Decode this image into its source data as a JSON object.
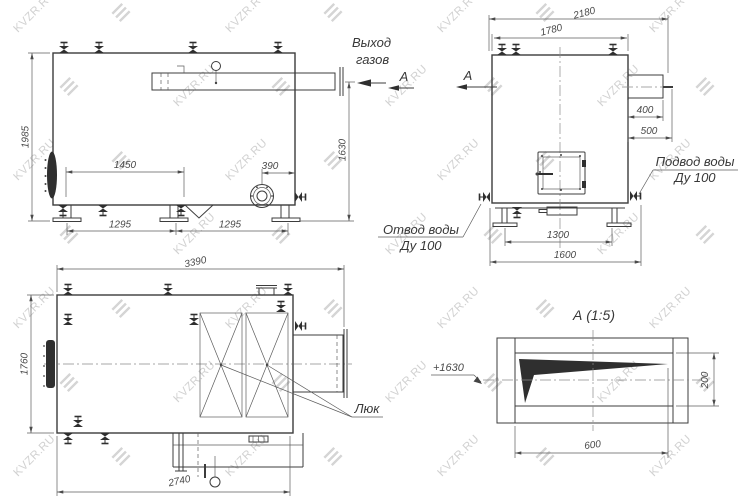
{
  "drawing": {
    "watermark_text": "KVZR.RU",
    "side_view": {
      "label_gas_outlet_line1": "Выход",
      "label_gas_outlet_line2": "газов",
      "section_letter": "А",
      "dim_height": "1985",
      "dim_valve_span": "1450",
      "dim_burner_offset": "390",
      "dim_support_left": "1295",
      "dim_support_right": "1295",
      "dim_gas_axis_height": "1630"
    },
    "front_view": {
      "section_letter": "А",
      "dim_overall_width": "2180",
      "dim_body_width": "1780",
      "dim_duct_length": "400",
      "dim_duct_overall": "500",
      "dim_support_span": "1300",
      "dim_base_width": "1600",
      "label_water_supply_line1": "Подвод воды",
      "label_water_supply_line2": "Ду 100",
      "label_water_return_line1": "Отвод воды",
      "label_water_return_line2": "Ду 100"
    },
    "plan_view": {
      "dim_overall_length": "3390",
      "dim_overall_width": "1760",
      "dim_bottom_length": "2740",
      "label_hatch": "Люк"
    },
    "detail_view": {
      "title": "А (1:5)",
      "elevation_mark": "+1630",
      "dim_height": "200",
      "dim_width": "600"
    }
  }
}
